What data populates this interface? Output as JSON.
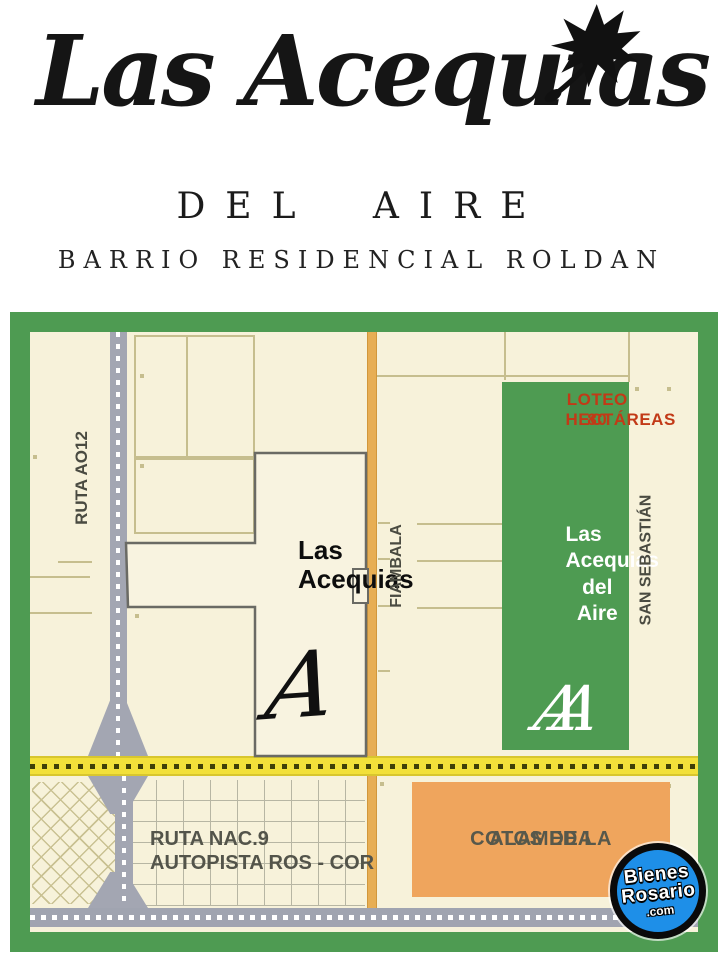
{
  "header": {
    "title": "Las Acequias",
    "subtitle": "DEL AIRE",
    "tagline": "BARRIO RESIDENCIAL ROLDAN",
    "leaf_icon": "maple-leaf",
    "text_color": "#151515"
  },
  "map": {
    "border_color": "#4E9B52",
    "background_color": "#F7F2DA",
    "streets": {
      "ruta_ao12": "RUTA AO12",
      "fiambala": "FIAMBALA",
      "san_sebastian": "SAN SEBASTIÁN"
    },
    "highway": {
      "line1": "RUTA NAC.9",
      "line2": "AUTOPISTA ROS - COR"
    },
    "loteo_badge": {
      "line1": "LOTEO 80",
      "line2": "HECTÁREAS",
      "text_color": "#C23A17"
    },
    "las_acequias": {
      "line1": "Las",
      "line2": "Acequias",
      "monogram": "A"
    },
    "las_acequias_del_aire": {
      "line1": "Las",
      "line2": "Acequias",
      "line3": "del Aire",
      "monogram": "AA",
      "fill_color": "#4E9B52"
    },
    "cotos_de_la_alameda": {
      "line1": "COTOS DE LA",
      "line2": "ALAMEDA",
      "fill_color": "#EFA55D"
    },
    "road_colors": {
      "ruta_ao12": "#A3A6B2",
      "fiambala": "#E7AE54",
      "yellow_road": "#F2E03A",
      "autopista": "#A0A4B0"
    }
  },
  "watermark": {
    "line1": "Bienes",
    "line2": "Rosario",
    "line3": ".com",
    "circle_color": "#1E8FE8"
  }
}
